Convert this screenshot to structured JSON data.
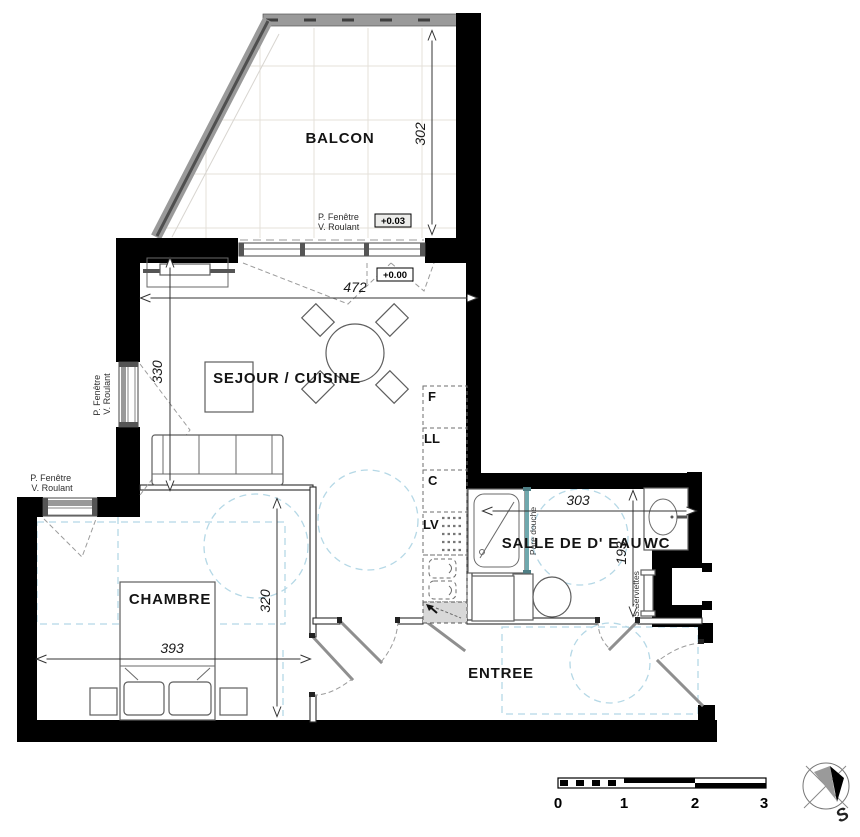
{
  "rooms": {
    "balcony": "BALCON",
    "living": "SEJOUR / CUISINE",
    "bedroom": "CHAMBRE",
    "bathroom": "SALLE DE D' EAU",
    "wc": "WC",
    "entry": "ENTREE"
  },
  "dimensions_cm": {
    "balcony_depth": "302",
    "living_width": "472",
    "living_depth": "330",
    "bedroom_width": "393",
    "bedroom_depth": "320",
    "bathroom_width": "303",
    "bathroom_depth": "193"
  },
  "floor_levels": {
    "balcony": "+0.03",
    "living": "+0.00"
  },
  "window_label": {
    "line1": "P. Fenêtre",
    "line2": "V. Roulant"
  },
  "kitchen_appliances": {
    "fridge": "F",
    "washing_machine": "LL",
    "cooktop": "C",
    "dishwasher": "LV"
  },
  "bathroom_labels": {
    "shower_screen": "Pare douche",
    "towel_dryer": "S.Serviettes"
  },
  "scale_bar": {
    "ticks": [
      "0",
      "1",
      "2",
      "3"
    ]
  },
  "compass": {
    "south_label": "S"
  },
  "colors": {
    "wall": "#000000",
    "accessibility_dash": "#b5d8e6",
    "shower_glass": "#6fa8ad",
    "railing_gray": "#999999",
    "duct_fill": "#d8d8d8"
  }
}
